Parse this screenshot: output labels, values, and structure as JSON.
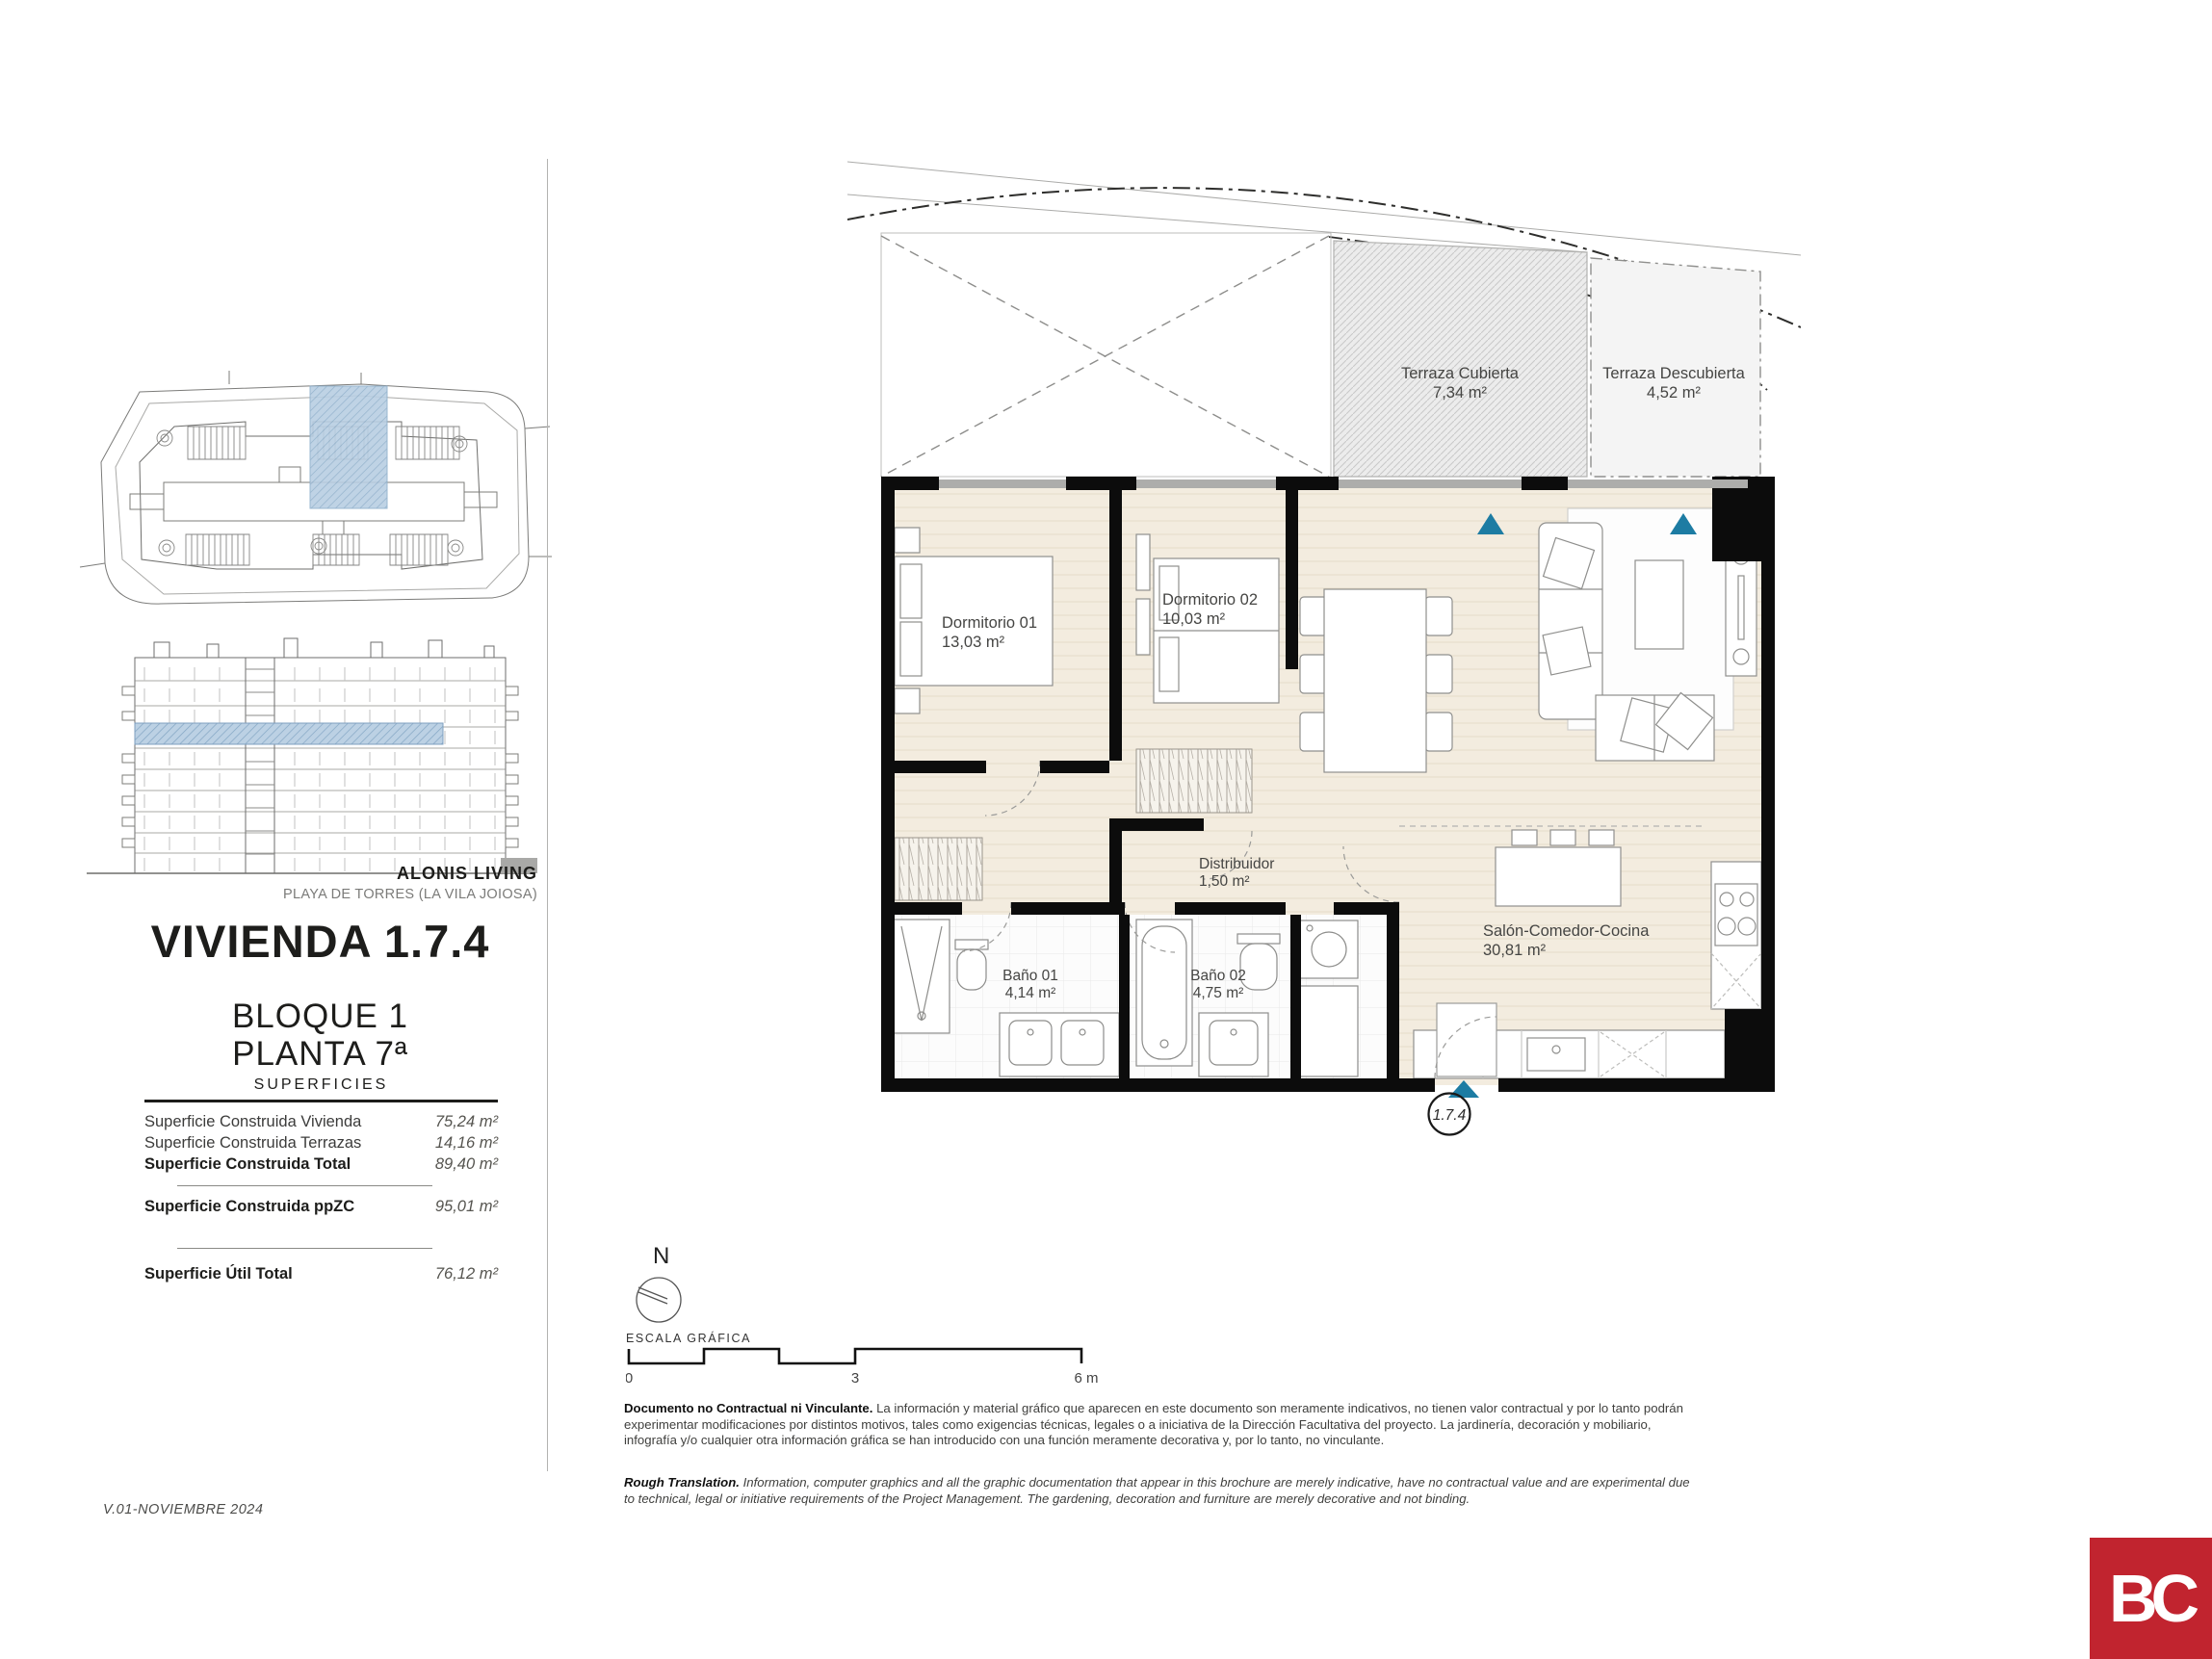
{
  "brand": {
    "name": "ALONIS LIVING",
    "location": "PLAYA DE TORRES (LA VILA JOIOSA)"
  },
  "unit": {
    "title": "VIVIENDA 1.7.4",
    "block": "BLOQUE 1",
    "floor": "PLANTA 7ª",
    "badge": "1.7.4"
  },
  "surfaces": {
    "header": "SUPERFICIES",
    "rows": [
      {
        "label": "Superficie Construida Vivienda",
        "value": "75,24 m²"
      },
      {
        "label": "Superficie Construida Terrazas",
        "value": "14,16 m²"
      },
      {
        "label": "Superficie Construida Total",
        "value": "89,40 m²"
      },
      {
        "label": "Superficie Construida ppZC",
        "value": "95,01 m²"
      },
      {
        "label": "Superficie Útil Total",
        "value": "76,12 m²"
      }
    ]
  },
  "plan": {
    "rooms": [
      {
        "name": "Dormitorio 01",
        "area": "13,03 m²"
      },
      {
        "name": "Dormitorio 02",
        "area": "10,03 m²"
      },
      {
        "name": "Distribuidor",
        "area": "1,50 m²"
      },
      {
        "name": "Baño 01",
        "area": "4,14 m²"
      },
      {
        "name": "Baño 02",
        "area": "4,75 m²"
      },
      {
        "name": "Salón-Comedor-Cocina",
        "area": "30,81 m²"
      },
      {
        "name": "Terraza Cubierta",
        "area": "7,34 m²"
      },
      {
        "name": "Terraza Descubierta",
        "area": "4,52 m²"
      }
    ]
  },
  "scale": {
    "compass": "N",
    "label": "ESCALA GRÁFICA",
    "ticks": [
      "0",
      "3",
      "6 m"
    ]
  },
  "disclaimer": {
    "es_lead": "Documento no Contractual ni Vinculante.",
    "es_body": " La información y material gráfico que aparecen en este documento son meramente indicativos, no tienen valor contractual y por lo tanto podrán experimentar modificaciones por distintos motivos, tales como exigencias técnicas, legales o a iniciativa de la Dirección Facultativa del proyecto. La jardinería, decoración y mobiliario, infografía y/o cualquier otra información gráfica se han introducido con una función meramente decorativa y, por lo tanto, no vinculante.",
    "en_lead": "Rough Translation.",
    "en_body": " Information, computer graphics and all the graphic documentation that appear in this brochure are merely indicative, have no contractual value and are experimental due to technical, legal or initiative requirements of the Project Management. The gardening, decoration and furniture are merely decorative and not binding."
  },
  "footer": {
    "version_note": "V.01-NOVIEMBRE 2024"
  },
  "logo": {
    "text": "BC"
  },
  "colors": {
    "accent_blue": "#1d7ca3",
    "highlight_blue": "#b9cfe3",
    "logo_red": "#c1242f"
  }
}
